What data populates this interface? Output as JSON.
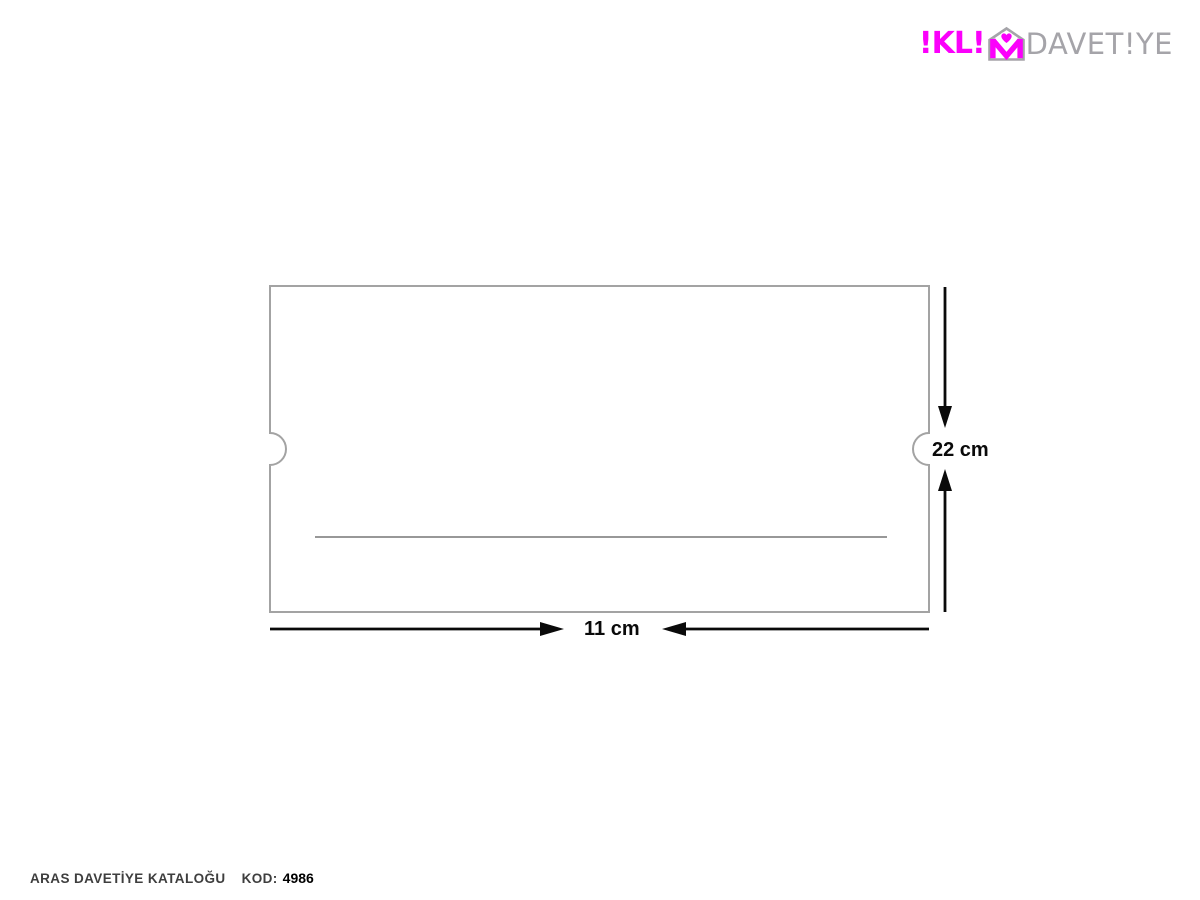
{
  "logo": {
    "brand_name": "İKLİM DAVETİYE",
    "primary_display": "!KL!",
    "secondary_display": "DAVET!YE",
    "accent_color": "#FB00FB",
    "gray_color": "#A5A4A9"
  },
  "diagram": {
    "shape": "rectangle card with semicircular thumb notches on left and right edges and a horizontal fold line",
    "height_label": "22 cm",
    "width_label": "11 cm",
    "card_border_color": "#A3A3A3",
    "fold_line_color": "#5B5B5B",
    "dimension_color": "#0A0A0A"
  },
  "footer": {
    "catalog_label": "ARAS DAVETİYE KATALOĞU",
    "code_label": "KOD:",
    "code_value": "4986"
  }
}
